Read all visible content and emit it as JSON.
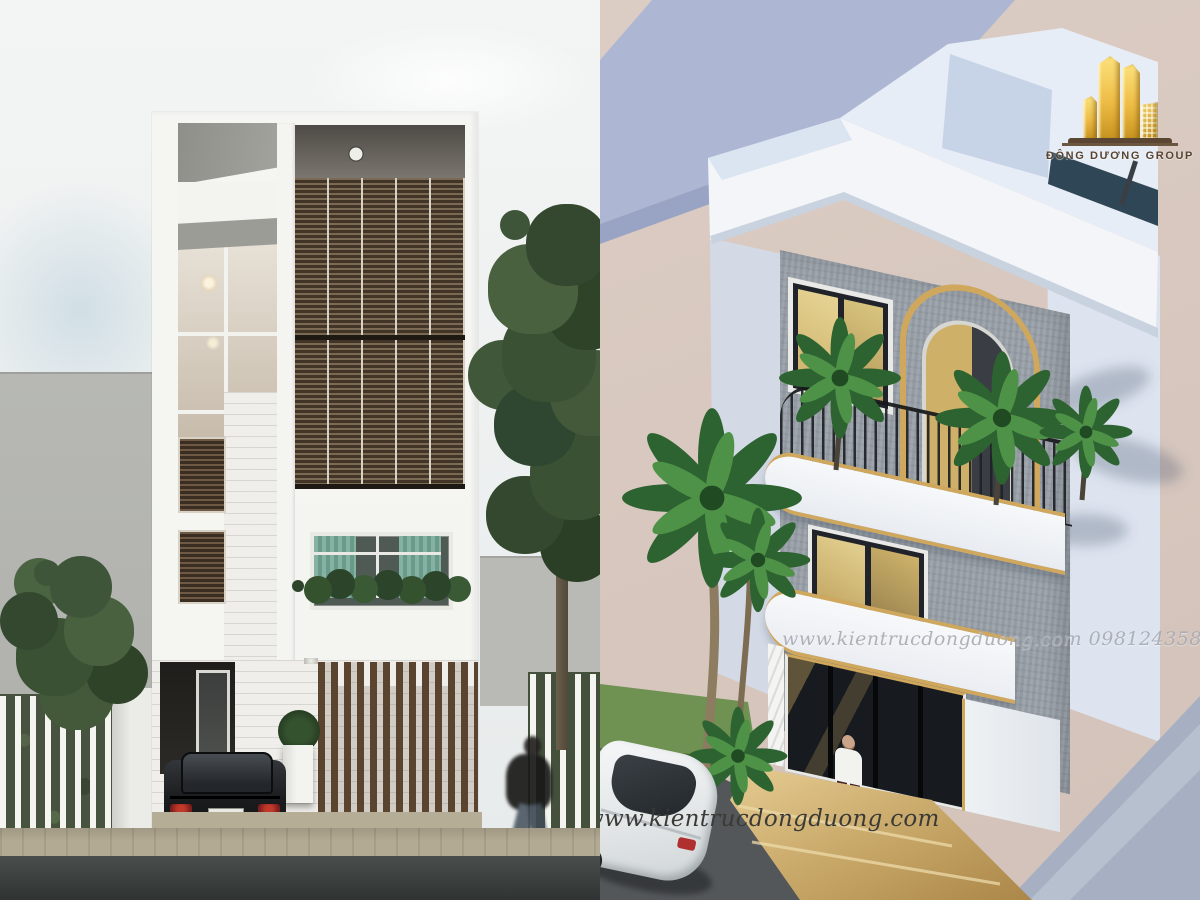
{
  "canvas": {
    "width": 1200,
    "height": 900
  },
  "left_panel": {
    "colors": {
      "sky": "#eef1f1",
      "side_wall_gray": "#b4b5b1",
      "facade_white": "#f5f5f2",
      "louver_wood": "#5d4736",
      "soffit_dark": "#55504b",
      "curtain_teal": "#7fae9e",
      "brick_white": "#efeeea",
      "gate_wood": "#5a442f",
      "car_black": "#17191b",
      "taillight_red": "#8a2020",
      "fence_white": "#f4f4f0",
      "hedge_green": "#47523f",
      "tree_green": "#3e5539",
      "cobble": "#b3aa93",
      "asphalt": "#3f4342"
    }
  },
  "right_panel": {
    "watermark_center": "www.kientrucdongduong.com 0981243588",
    "watermark_bottom": "www.kientrucdongduong.com",
    "logo": {
      "label": "ĐÔNG DƯƠNG GROUP",
      "gold": "#e9bc4a",
      "base_bar": "#5a4632"
    },
    "colors": {
      "background_beige": "#d8c8c0",
      "neighbor_blue": "#adb7d3",
      "roof_white": "#eef2f8",
      "pool_edge": "#2f4656",
      "facade_concrete": "#9aa1a9",
      "gold_trim": "#cfa75d",
      "glass_gold": "#d9c57e",
      "railing_black": "#1e2125",
      "palm_green": "#2d6330",
      "steps_gold": "#c9a96a",
      "ground_blue": "#a6b0c2",
      "road_dark": "#53575a",
      "watermark_gray": "#a2a4ae",
      "watermark_dark": "#3a3a36"
    }
  }
}
